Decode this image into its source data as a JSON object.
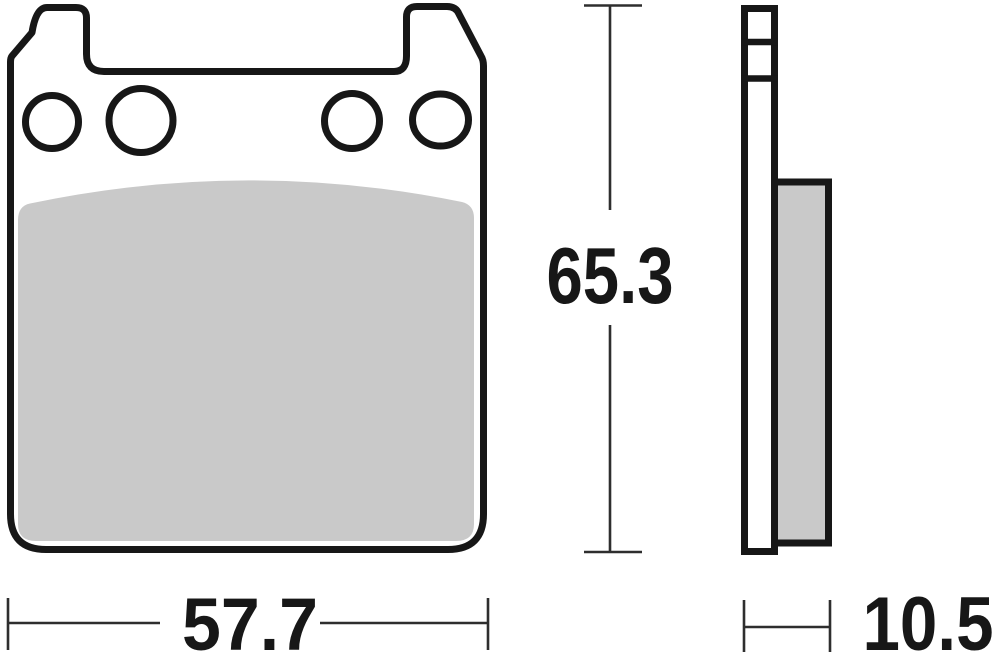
{
  "drawing_type": "brake-pad-dimension-diagram",
  "dimensions": {
    "width": "57.7",
    "height": "65.3",
    "thickness": "10.5"
  },
  "colors": {
    "outline": "#171717",
    "dimension_line": "#2e2e2e",
    "friction_fill": "#c9c9c9",
    "background": "#ffffff"
  }
}
